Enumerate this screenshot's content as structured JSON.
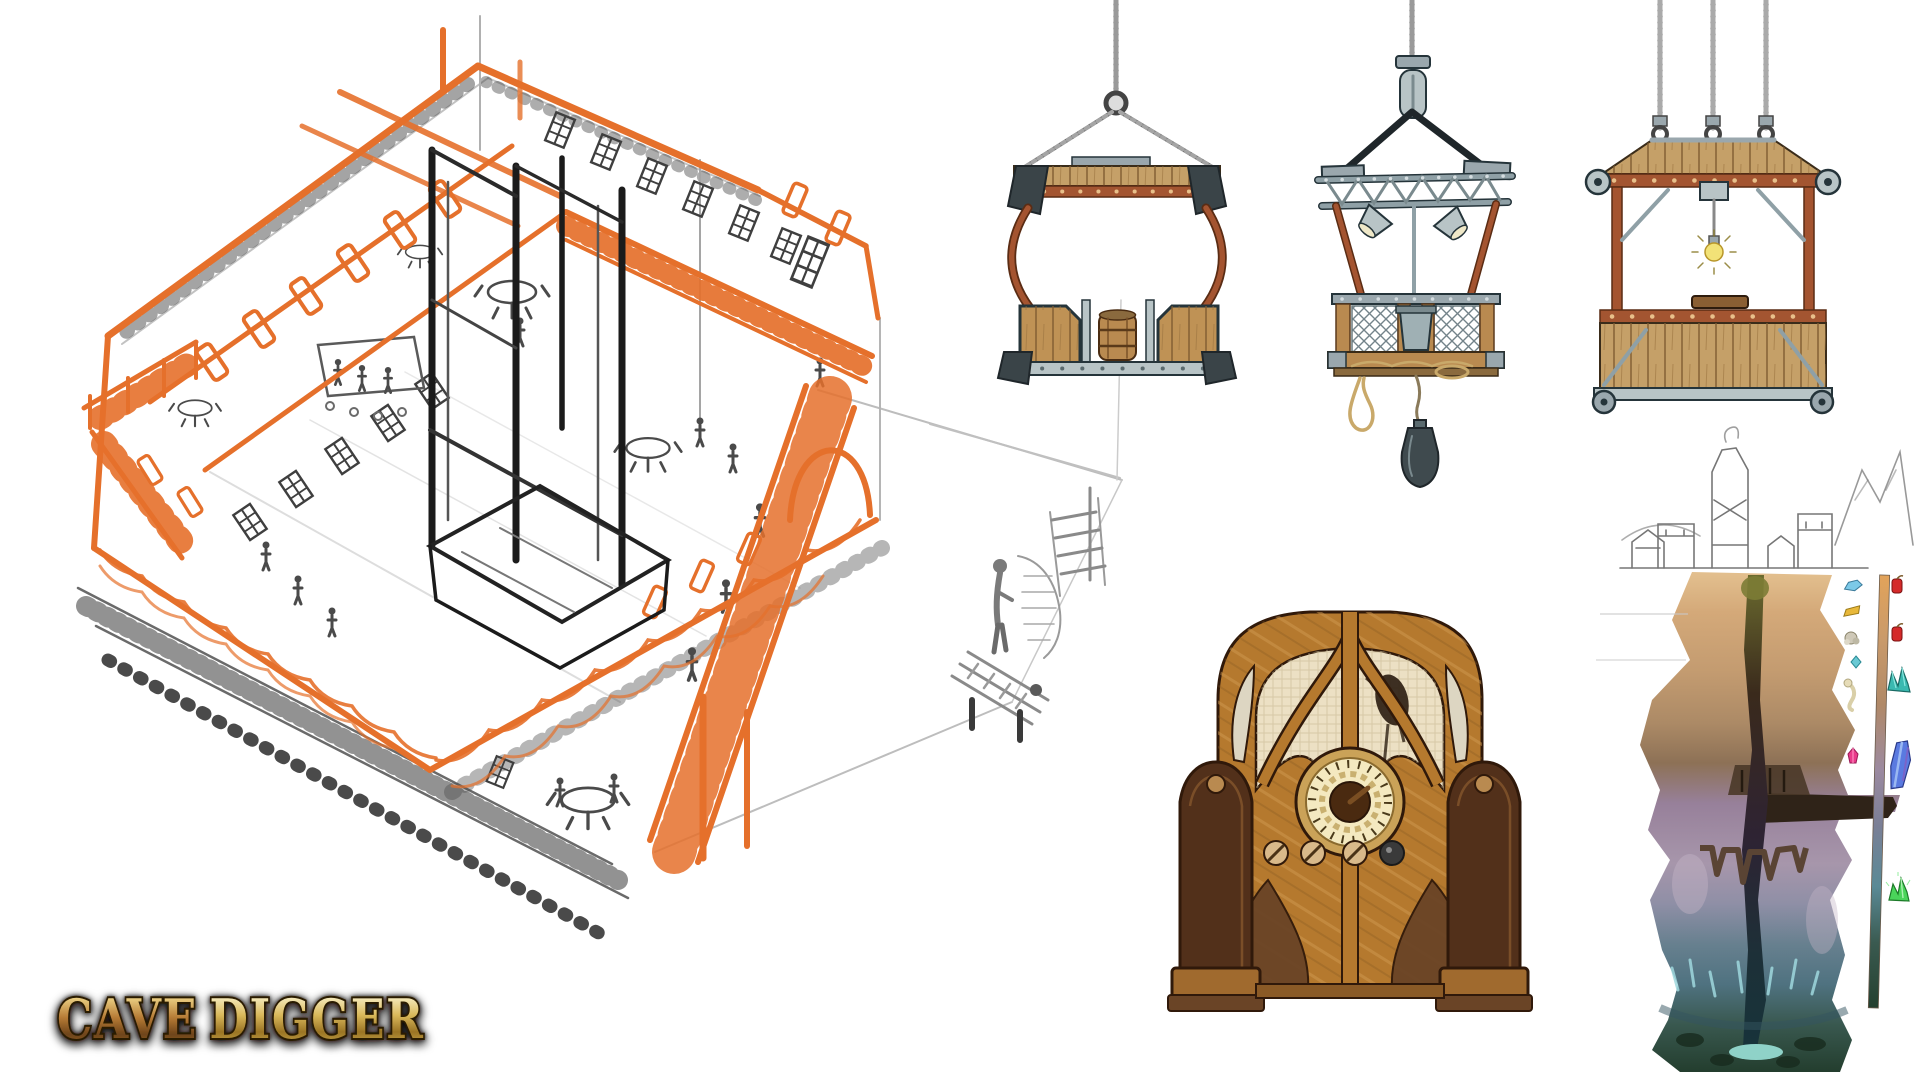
{
  "page": {
    "background": "#ffffff",
    "description": "Cave Digger concept art sheet"
  },
  "logo": {
    "word1": "CAVE",
    "word2": "DIGGER",
    "gold_light": "#f7eec2",
    "gold_dark": "#8a5c18",
    "copper": "#a96a32",
    "outline": "#2b1a06"
  },
  "sketch": {
    "label": "saloon-interior-isometric-sketch",
    "accent_orange": "#e5702b",
    "pencil_gray": "#5a5a5a",
    "ink_black": "#1b1b1b"
  },
  "mini_sketch": {
    "label": "staircase-and-minecart-sketch",
    "pencil_gray": "#8a8a8a"
  },
  "elevators": {
    "wood": "#c5a068",
    "copper": "#a35531",
    "metal": "#b8c4c6",
    "outline": "#25343a",
    "rope": "#6a6a6a",
    "items": [
      {
        "name": "cage-with-barrel"
      },
      {
        "name": "truss-basket-with-lamps-and-counterweight"
      },
      {
        "name": "platform-with-three-ropes-and-bulb"
      }
    ]
  },
  "radio": {
    "label": "vintage-cathedral-radio",
    "wood": "#b5792e",
    "dark_wood": "#52301a",
    "cloth": "#ece0c4",
    "dial_face": "#f4e9c0",
    "knob_light": "#d9b98a",
    "knob_dark": "#3a3a3a"
  },
  "cave": {
    "label": "mine-depth-cross-section",
    "layer_colors": [
      "#e3c08f",
      "#c39b70",
      "#8d7156",
      "#a796ab",
      "#67808f",
      "#4f7280",
      "#223c2c"
    ],
    "pool": "#8fd2c8",
    "legend_items_left": [
      "blue-gem",
      "gold-bar",
      "silver-ore",
      "teal-gem",
      "bone",
      "pink-gem"
    ],
    "legend_items_right": [
      "dynamite",
      "dynamite",
      "teal-crystal-cluster",
      "blue-crystal",
      "green-crystal"
    ]
  }
}
